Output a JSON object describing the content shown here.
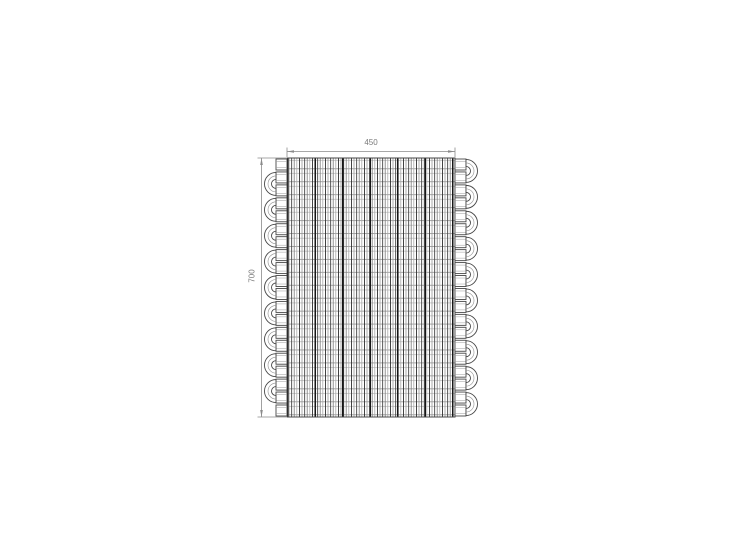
{
  "canvas": {
    "background": "#ffffff"
  },
  "drawing": {
    "subject": "fin-and-tube serpentine coil heat exchanger, front elevation",
    "dim_width_label": "450",
    "dim_height_label": "700",
    "tube_passes": 20,
    "left_bends": 9,
    "right_bends": 10,
    "colors": {
      "outline": "#474747",
      "dimension": "#7a7a7a",
      "fin_dark": "#2e2e2e",
      "fin_mid": "#6e6e6e",
      "fin_light": "#a8a8a8",
      "tube_line": "#8f8f8f"
    }
  }
}
